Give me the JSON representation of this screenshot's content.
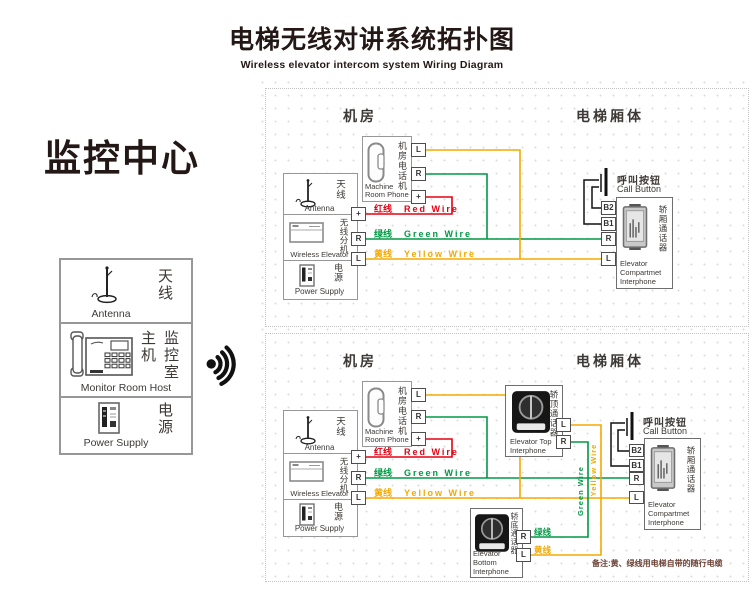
{
  "title": {
    "zh": "电梯无线对讲系统拓扑图",
    "en": "Wireless elevator intercom system Wiring Diagram"
  },
  "monitor_center": {
    "heading": "监控中心",
    "antenna_zh": "天线",
    "antenna_en": "Antenna",
    "host_col_left": "主机",
    "host_col_right": "监控室",
    "host_en": "Monitor Room Host",
    "power_zh": "电源",
    "power_en": "Power Supply"
  },
  "labels": {
    "machine_room": "机房",
    "elevator_body": "电梯厢体",
    "phone_zh": "机房电话机",
    "phone_en": "Machine Room Phone",
    "antenna_zh": "天线",
    "antenna_en": "Antenna",
    "wireless_zh": "无线分机",
    "wireless_en": "Wireless Elevator",
    "power_zh": "电源",
    "power_en": "Power Supply",
    "red_zh": "红线",
    "red_en": "Red Wire",
    "green_zh": "绿线",
    "green_en": "Green Wire",
    "yellow_zh": "黄线",
    "yellow_en": "Yellow Wire",
    "call_zh": "呼叫按钮",
    "call_en": "Call Button",
    "compartment_zh": "轿厢通话器",
    "compartment_en": "Elevator Compartmet Interphone",
    "top_zh": "轿顶通话器",
    "top_en": "Elevator Top Interphone",
    "bottom_zh": "轿底通话器",
    "bottom_en": "Elevator Bottom Interphone"
  },
  "terminals": {
    "l": "L",
    "r": "R",
    "plus": "+",
    "b1": "B1",
    "b2": "B2"
  },
  "note": "备注:黄、绿线用电梯自带的随行电缆",
  "colors": {
    "red": "#e60012",
    "green": "#009944",
    "yellow": "#f5a800",
    "ink": "#231815"
  }
}
